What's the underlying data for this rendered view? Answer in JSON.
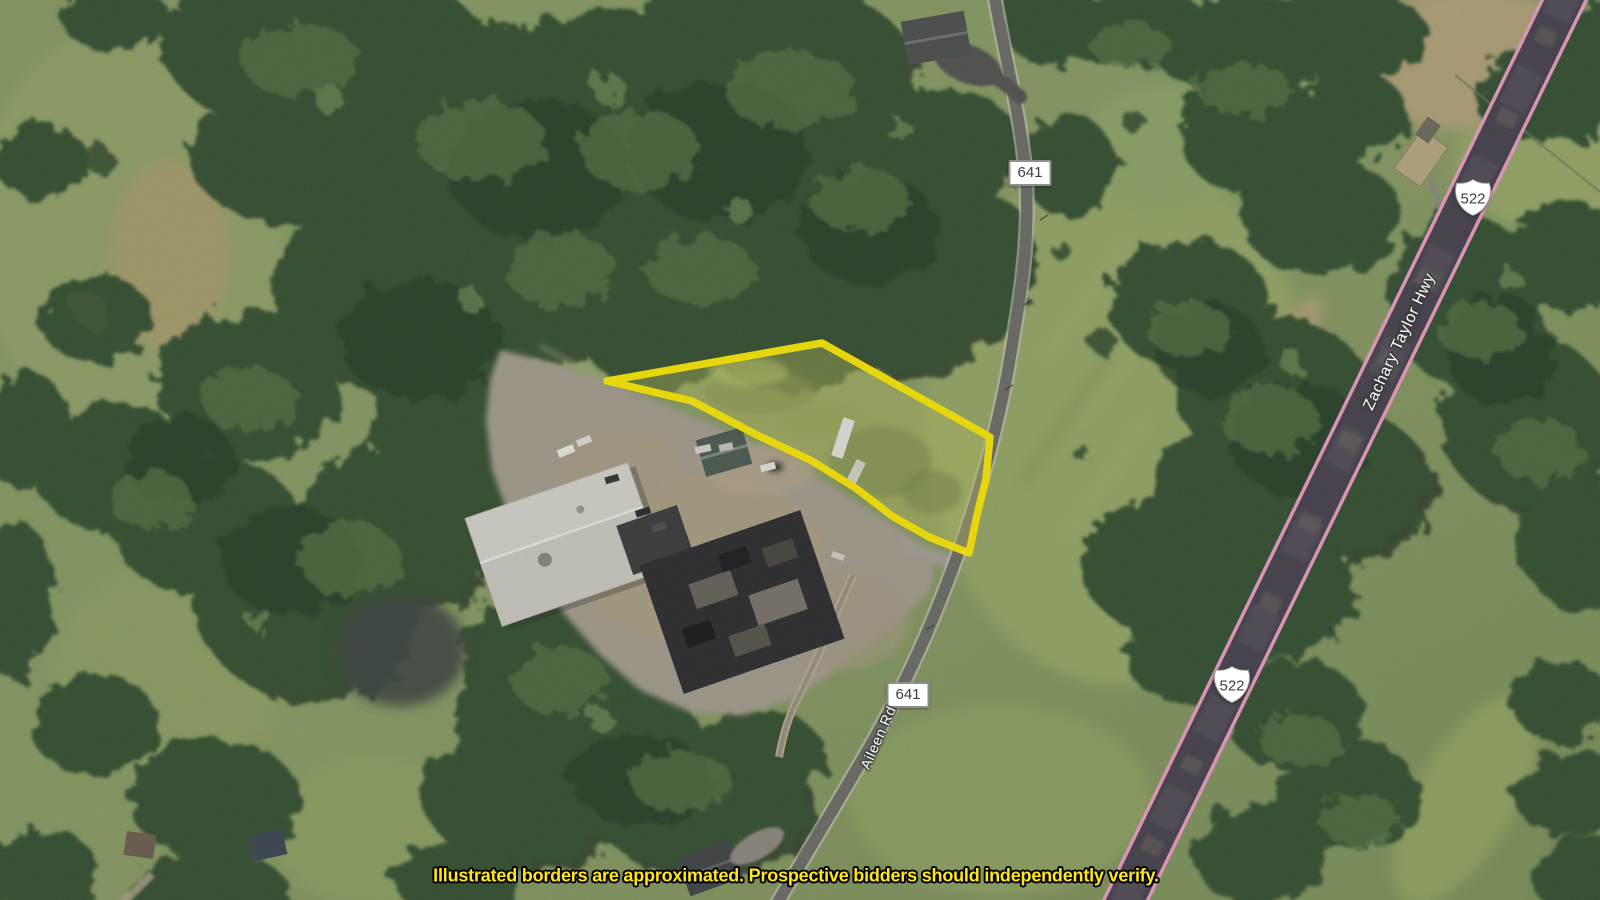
{
  "meta": {
    "type": "aerial-property-auction-map",
    "width_px": 1600,
    "height_px": 900
  },
  "parcel": {
    "outline_color": "#ffec00"
  },
  "shields": {
    "route_641_top": {
      "label": "641",
      "style": "rect"
    },
    "route_641_bottom": {
      "label": "641",
      "style": "rect"
    },
    "route_522_top": {
      "label": "522",
      "style": "us-shield"
    },
    "route_522_bottom": {
      "label": "522",
      "style": "us-shield"
    }
  },
  "road_names": {
    "zachary_taylor_hwy": "Zachary Taylor Hwy",
    "aileen_rd": "Aileen Rd"
  },
  "disclaimer": {
    "text": "Illustrated borders are approximated. Prospective bidders should independently verify.",
    "color": "#ffe615"
  },
  "highway_overlay_color": "#ef9fc4"
}
